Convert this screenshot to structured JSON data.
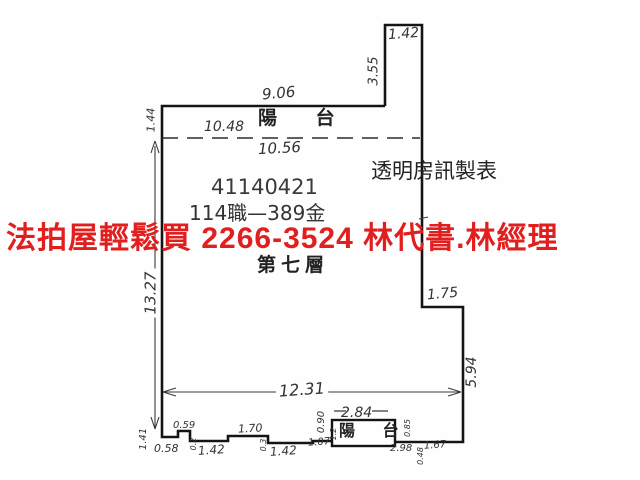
{
  "watermark": {
    "text": "法拍屋輕鬆買  2266-3524  林代書.林經理",
    "color": "#e11f1f"
  },
  "plan": {
    "texts": {
      "balcony_top": "陽 台",
      "balcony_bottom": "陽 台",
      "doc_number": "41140421",
      "doc_ref": "114職—389金",
      "maker": "透明房訊製表",
      "floor": "第七層"
    },
    "dims": {
      "protrusion_top_width": "1.42",
      "protrusion_height": "3.55",
      "top_edge_width": "9.06",
      "balcony_inner_width": "10.48",
      "balcony_outer_width": "10.56",
      "balcony_depth": "1.44",
      "left_height": "13.27",
      "right_step_width": "1.75",
      "right_lower_height": "5.94",
      "bottom_inner_width": "12.31",
      "bottom_left_height": "1.41",
      "seg_058": "0.58",
      "seg_059": "0.59",
      "step_02": "0.2",
      "seg_142_a": "1.42",
      "seg_170": "1.70",
      "step_03": "0.3",
      "seg_142_b": "1.42",
      "seg_107": "1.07",
      "bottom_balcony_width": "2.84",
      "bottom_balcony_depth": "0.90",
      "tick_12": "1.2",
      "tick_085": "0.85",
      "seg_298": "2.98",
      "tick_048": "0.48",
      "seg_167": "1.67"
    }
  },
  "colors": {
    "ink": "#141414",
    "dim_line": "#3a3a3a",
    "watermark_red": "#e11f1f",
    "background": "#fefefe"
  }
}
